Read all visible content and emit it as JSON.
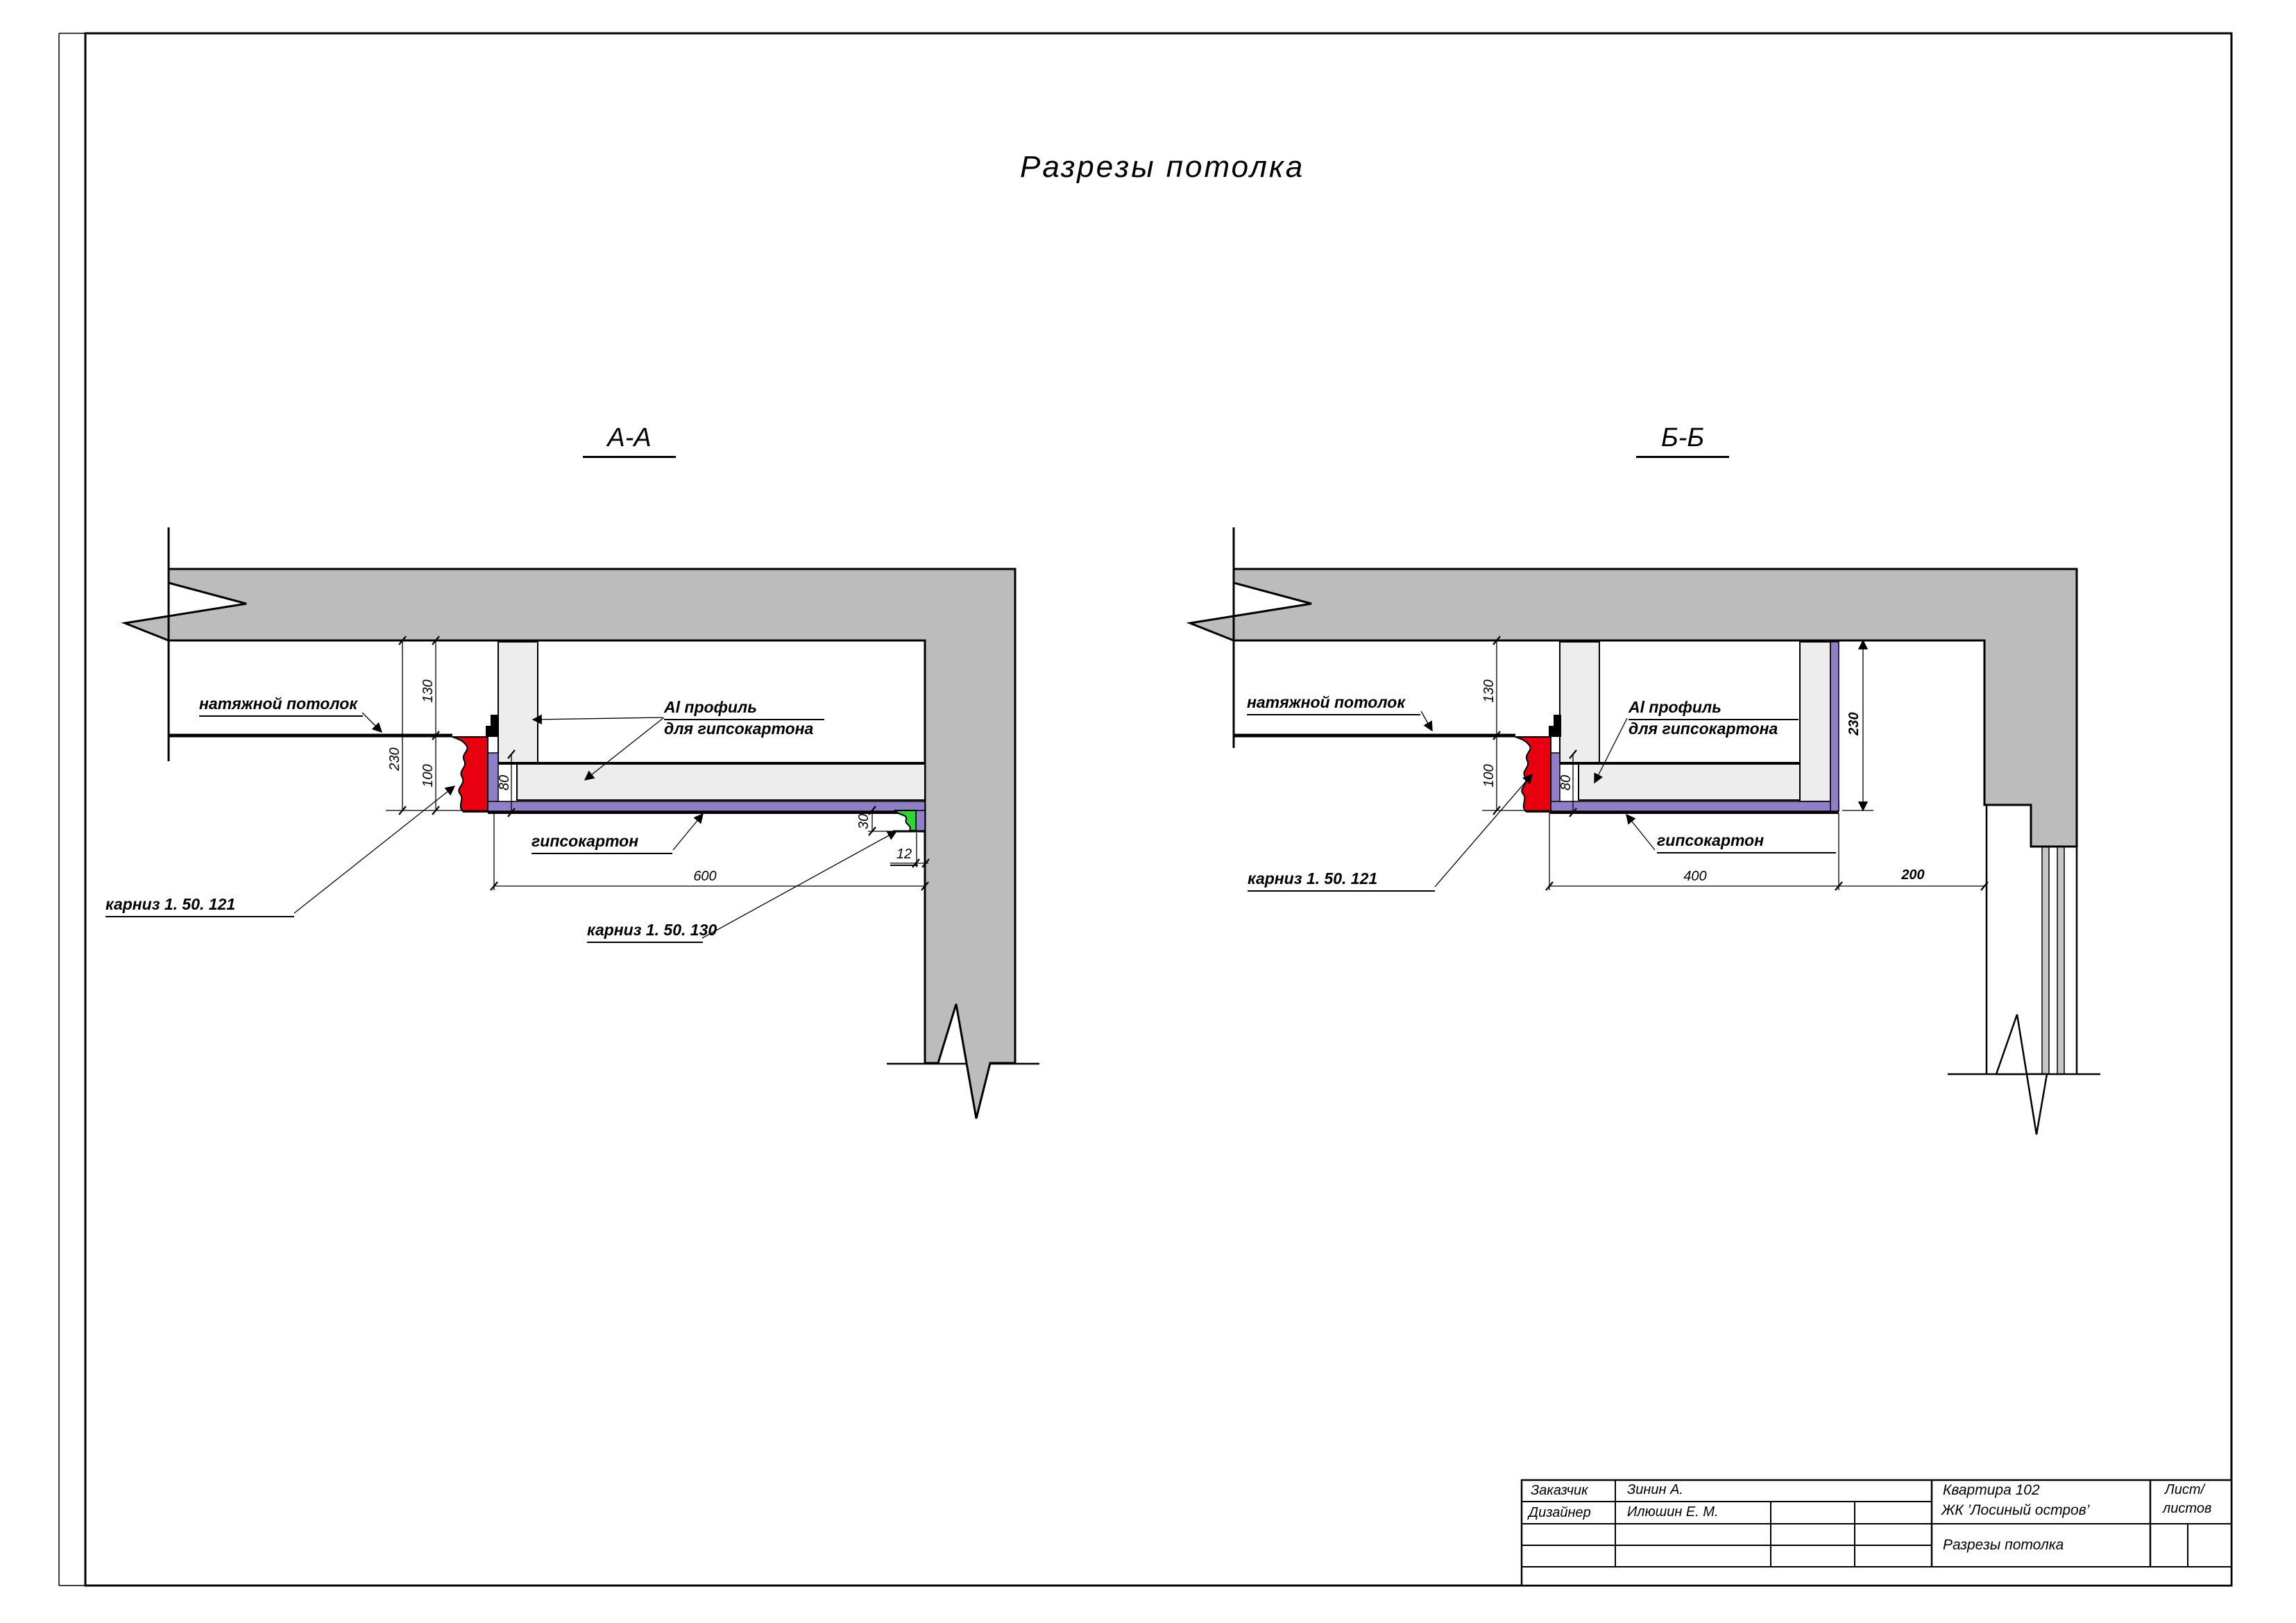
{
  "page_title": "Разрезы потолка",
  "section_a": {
    "header": "А-А",
    "labels": {
      "stretch_ceiling": "натяжной потолок",
      "cornice_main": "карниз 1. 50. 121",
      "al_profile_line1": "Al профиль",
      "al_profile_line2": "для гипсокартона",
      "gypsum": "гипсокартон",
      "cornice_small": "карниз 1. 50. 130"
    },
    "dims": {
      "d130": "130",
      "d230": "230",
      "d100": "100",
      "d80": "80",
      "d600": "600",
      "d30": "30",
      "d12": "12"
    }
  },
  "section_b": {
    "header": "Б-Б",
    "labels": {
      "stretch_ceiling": "натяжной потолок",
      "cornice_main": "карниз 1. 50. 121",
      "al_profile_line1": "Al профиль",
      "al_profile_line2": "для гипсокартона",
      "gypsum": "гипсокартон"
    },
    "dims": {
      "d130": "130",
      "d100": "100",
      "d80": "80",
      "d230": "230",
      "d400": "400",
      "d200": "200"
    }
  },
  "title_block": {
    "customer_label": "Заказчик",
    "customer_name": "Зинин А.",
    "designer_label": "Дизайнер",
    "designer_name": "Илюшин Е. М.",
    "project_line1": "Квартира 102",
    "project_line2": "ЖК ’Лосиный остров’",
    "sheet_label_line1": "Лист/",
    "sheet_label_line2": "листов",
    "drawing_title": "Разрезы потолка"
  },
  "colors": {
    "slab_gray": "#bcbcbc",
    "profile_gray": "#ededed",
    "window_gray": "#c6c6c6",
    "gypsum_purple": "#8f7fc6",
    "cornice_red": "#e80011",
    "cornice_green": "#2fd435",
    "line_black": "#000000"
  }
}
